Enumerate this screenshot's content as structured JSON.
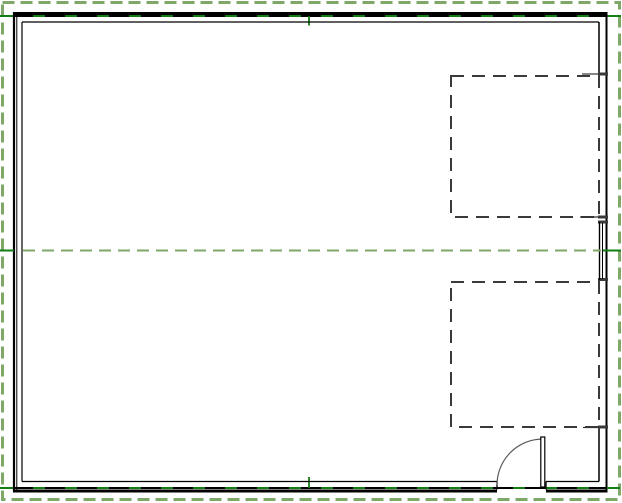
{
  "app": {
    "view_name": "floor-plan-view",
    "description": "CAD floor plan: rectangular building outline with two hidden-line (dashed) openings on the right wall, a window element mid-right, an inswing door at bottom right, and green property/boundary lines"
  },
  "canvas": {
    "width": 622,
    "height": 503,
    "background": "#ffffff"
  },
  "colors": {
    "wall": "#000000",
    "hidden": "#3a3a3a",
    "lead": "#333333",
    "prop_green": "#127d12",
    "boundary_green": "#7ea768",
    "arc_gray": "#5a5a5a",
    "white": "#ffffff"
  },
  "elements": [
    {
      "type": "rect",
      "name": "site-boundary-dashed",
      "interactable": true,
      "x": 2.5,
      "y": 2.5,
      "w": 617,
      "h": 497,
      "stroke": "boundary_green",
      "sw": 3,
      "dash": "12,6",
      "fill": "none"
    },
    {
      "type": "rect",
      "name": "top-wall",
      "interactable": true,
      "x": 13,
      "y": 12,
      "w": 594,
      "h": 3.5,
      "fill": "wall"
    },
    {
      "type": "line",
      "name": "property-line-top",
      "interactable": true,
      "x1": 0,
      "y1": 16,
      "x2": 621,
      "y2": 16,
      "stroke": "prop_green",
      "sw": 2
    },
    {
      "type": "line",
      "name": "top-wall-overlay-dashes",
      "interactable": false,
      "x1": 13,
      "y1": 16,
      "x2": 607,
      "y2": 16,
      "stroke": "wall",
      "sw": 2,
      "dash": "20,12"
    },
    {
      "type": "line",
      "name": "property-tick-top",
      "interactable": false,
      "x1": 309,
      "y1": 16,
      "x2": 309,
      "y2": 25.5,
      "stroke": "prop_green",
      "sw": 1.8
    },
    {
      "type": "line",
      "name": "left-wall-outer-face",
      "interactable": true,
      "x1": 14,
      "y1": 12,
      "x2": 14,
      "y2": 492,
      "stroke": "wall",
      "sw": 2.2
    },
    {
      "type": "line",
      "name": "left-wall-core-face",
      "interactable": false,
      "x1": 16.8,
      "y1": 13,
      "x2": 16.8,
      "y2": 490.5,
      "stroke": "wall",
      "sw": 1
    },
    {
      "type": "line",
      "name": "left-wall-inner-face",
      "interactable": false,
      "x1": 22,
      "y1": 22,
      "x2": 22,
      "y2": 481.5,
      "stroke": "wall",
      "sw": 1.2
    },
    {
      "type": "line",
      "name": "top-wall-inner-face",
      "interactable": false,
      "x1": 22,
      "y1": 22,
      "x2": 599,
      "y2": 22,
      "stroke": "wall",
      "sw": 1.2
    },
    {
      "type": "rect",
      "name": "upper-hidden-opening-outline",
      "interactable": true,
      "x": 451,
      "y": 76,
      "w": 148,
      "h": 141,
      "stroke": "hidden",
      "sw": 2,
      "dash": "13,8",
      "fill": "none"
    },
    {
      "type": "rect",
      "name": "lower-hidden-opening-outline",
      "interactable": true,
      "x": 451,
      "y": 282,
      "w": 148,
      "h": 145,
      "stroke": "hidden",
      "sw": 2,
      "dash": "13,8",
      "fill": "none"
    },
    {
      "type": "line",
      "name": "right-wall-outer-face",
      "interactable": true,
      "x1": 606.5,
      "y1": 12,
      "x2": 606.5,
      "y2": 492.5,
      "stroke": "wall",
      "sw": 2
    },
    {
      "type": "line",
      "name": "right-wall-inner-face-upper",
      "interactable": false,
      "x1": 599,
      "y1": 22,
      "x2": 599,
      "y2": 74,
      "stroke": "wall",
      "sw": 1.5
    },
    {
      "type": "line",
      "name": "right-wall-inner-face-lower",
      "interactable": false,
      "x1": 599,
      "y1": 427.5,
      "x2": 599,
      "y2": 481.5,
      "stroke": "wall",
      "sw": 1.5
    },
    {
      "type": "line",
      "name": "jamb-lead-upper-head",
      "interactable": false,
      "x1": 582,
      "y1": 74,
      "x2": 598,
      "y2": 74,
      "stroke": "lead",
      "sw": 1.2
    },
    {
      "type": "line",
      "name": "jamb-lead-upper-sill",
      "interactable": false,
      "x1": 580,
      "y1": 217,
      "x2": 598,
      "y2": 217,
      "stroke": "lead",
      "sw": 1.2
    },
    {
      "type": "line",
      "name": "jamb-lead-lower-sill",
      "interactable": false,
      "x1": 583,
      "y1": 427.5,
      "x2": 598,
      "y2": 427.5,
      "stroke": "lead",
      "sw": 1.2
    },
    {
      "type": "rect",
      "name": "opening-upper-head-jamb-cap",
      "interactable": false,
      "x": 598,
      "y": 72.5,
      "w": 10,
      "h": 3,
      "fill": "hidden"
    },
    {
      "type": "rect",
      "name": "opening-upper-sill-jamb-cap",
      "interactable": false,
      "x": 598,
      "y": 215.5,
      "w": 10,
      "h": 3,
      "fill": "hidden"
    },
    {
      "type": "rect",
      "name": "opening-lower-sill-jamb-cap",
      "interactable": false,
      "x": 598,
      "y": 425.5,
      "w": 10,
      "h": 3,
      "fill": "hidden"
    },
    {
      "type": "rect",
      "name": "window-head-cap",
      "interactable": false,
      "x": 598,
      "y": 220.5,
      "w": 10,
      "h": 3,
      "fill": "hidden"
    },
    {
      "type": "rect",
      "name": "window-sill-cap",
      "interactable": false,
      "x": 598,
      "y": 278,
      "w": 10,
      "h": 3,
      "fill": "hidden"
    },
    {
      "type": "line",
      "name": "window-inner-line-1",
      "interactable": true,
      "x1": 599.5,
      "y1": 222,
      "x2": 599.5,
      "y2": 280,
      "stroke": "wall",
      "sw": 1.4
    },
    {
      "type": "line",
      "name": "window-inner-line-2",
      "interactable": false,
      "x1": 602.5,
      "y1": 223,
      "x2": 602.5,
      "y2": 279,
      "stroke": "wall",
      "sw": 1
    },
    {
      "type": "line",
      "name": "property-line-mid-left",
      "interactable": true,
      "x1": 0,
      "y1": 250.5,
      "x2": 14,
      "y2": 250.5,
      "stroke": "prop_green",
      "sw": 2
    },
    {
      "type": "line",
      "name": "property-line-mid-hidden",
      "interactable": true,
      "x1": 23,
      "y1": 250.5,
      "x2": 601,
      "y2": 250.5,
      "stroke": "boundary_green",
      "sw": 2,
      "dash": "12,7"
    },
    {
      "type": "line",
      "name": "property-line-mid-right",
      "interactable": true,
      "x1": 603,
      "y1": 250.5,
      "x2": 621,
      "y2": 250.5,
      "stroke": "prop_green",
      "sw": 2
    },
    {
      "type": "line",
      "name": "property-line-bottom",
      "interactable": true,
      "x1": 0,
      "y1": 488,
      "x2": 620,
      "y2": 488,
      "stroke": "prop_green",
      "sw": 2
    },
    {
      "type": "line",
      "name": "bottom-wall-overlay-dashes",
      "interactable": false,
      "x1": 13,
      "y1": 488,
      "x2": 607,
      "y2": 488,
      "stroke": "wall",
      "sw": 2,
      "dash": "20,12"
    },
    {
      "type": "line",
      "name": "property-tick-bottom",
      "interactable": false,
      "x1": 309,
      "y1": 477,
      "x2": 309,
      "y2": 488,
      "stroke": "prop_green",
      "sw": 1.8
    },
    {
      "type": "rect",
      "name": "bottom-wall-left",
      "interactable": true,
      "x": 13,
      "y": 489.5,
      "w": 484,
      "h": 3,
      "fill": "wall"
    },
    {
      "type": "rect",
      "name": "bottom-wall-right",
      "interactable": true,
      "x": 546,
      "y": 489.5,
      "w": 61,
      "h": 3,
      "fill": "wall"
    },
    {
      "type": "line",
      "name": "bottom-wall-inner-face-left",
      "interactable": false,
      "x1": 22,
      "y1": 481.5,
      "x2": 497,
      "y2": 481.5,
      "stroke": "wall",
      "sw": 1.2
    },
    {
      "type": "line",
      "name": "bottom-wall-inner-face-right",
      "interactable": false,
      "x1": 546,
      "y1": 481.5,
      "x2": 599,
      "y2": 481.5,
      "stroke": "wall",
      "sw": 1.2
    },
    {
      "type": "line",
      "name": "door-jamb-left",
      "interactable": false,
      "x1": 497,
      "y1": 481.5,
      "x2": 497,
      "y2": 489.5,
      "stroke": "wall",
      "sw": 1.3
    },
    {
      "type": "line",
      "name": "door-jamb-right",
      "interactable": false,
      "x1": 546,
      "y1": 481.5,
      "x2": 546,
      "y2": 489.5,
      "stroke": "wall",
      "sw": 1.3
    },
    {
      "type": "path",
      "name": "door-swing-arc",
      "interactable": true,
      "d": "M 497 485 A 46 46 0 0 1 543 439",
      "stroke": "arc_gray",
      "sw": 1.2,
      "fill": "none"
    },
    {
      "type": "rect",
      "name": "door-leaf",
      "interactable": true,
      "x": 540.8,
      "y": 437,
      "w": 4,
      "h": 50,
      "stroke": "wall",
      "sw": 1.2,
      "fill": "white"
    }
  ]
}
